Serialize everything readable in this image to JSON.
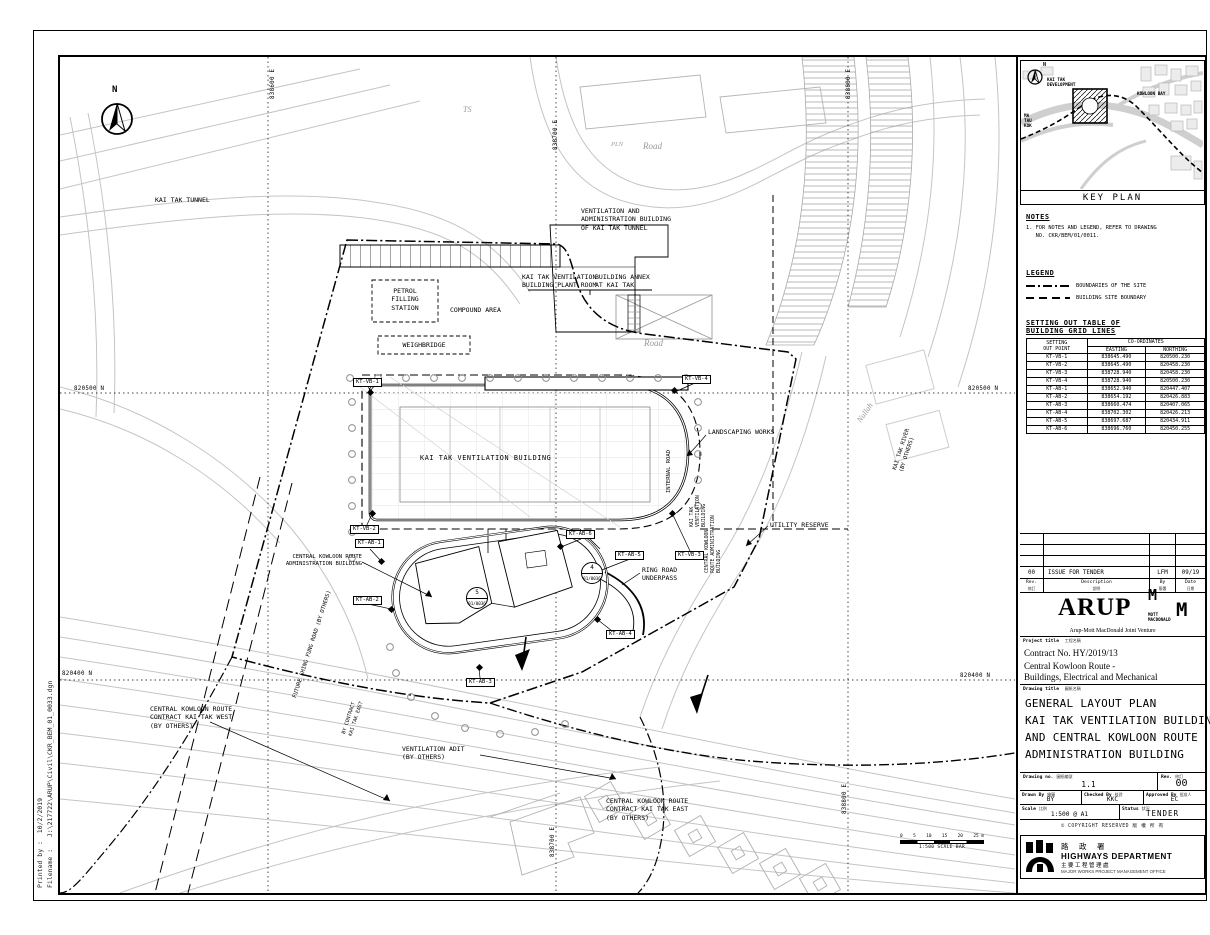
{
  "sheet": {
    "printed_by": "Printed by :  10/2/2019",
    "filename": "Filename :   J:\\217722\\ARUP\\Civil\\CKR_BEM_01_0033.dgn"
  },
  "plan": {
    "north": "N",
    "kai_tak_tunnel": "KAI TAK TUNNEL",
    "ts": "TS",
    "pln": "PLN",
    "road_top": "Road",
    "road_mid": "Road",
    "vent_admin_building": "VENTILATION AND\nADMINISTRATION BUILDING\nOF KAI TAK TUNNEL",
    "plant_room": "KAI TAK VENTILATION\nBUILDING PLANT ROOM",
    "building_annex": "BUILDING ANNEX\nAT KAI TAK",
    "petrol_station": "PETROL\nFILLING\nSTATION",
    "compound_area": "COMPOUND AREA",
    "weighbridge": "WEIGHBRIDGE",
    "main_building": "KAI TAK VENTILATION BUILDING",
    "internal_road": "INTERNAL ROAD",
    "landscaping": "LANDSCAPING WORKS",
    "utility_reserve": "UTILITY RESERVE",
    "kai_tak_river": "KAI TAK RIVER\n(BY OTHERS)",
    "nullah": "Nullah",
    "admin_building": "CENTRAL KOWLOON ROUTE\nADMINISTRATION BUILDING",
    "ring_road_underpass": "RING ROAD\nUNDERPASS",
    "vb_side": "KAI TAK\nVENTILATION\nBUILDING",
    "ab_side": "CENTRAL KOWLOON\nROUTE ADMINISTRATION\nBUILDING",
    "future_road": "FUTURE SHING FUNG ROAD (BY OTHERS)",
    "by_contract_east": "BY CONTRACT\nKAI TAK EAST",
    "ckr_west": "CENTRAL KOWLOON ROUTE\nCONTRACT KAI TAK WEST\n(BY OTHERS)",
    "vent_adit": "VENTILATION ADIT\n(BY OTHERS)",
    "ckr_east": "CENTRAL KOWLOON ROUTE\nCONTRACT KAI TAK EAST\n(BY OTHERS)",
    "grid_e1": "838600 E",
    "grid_e2": "838700 E",
    "grid_e3": "838800 E",
    "grid_n500": "820500 N",
    "grid_n400": "820400 N",
    "points": {
      "vb1": "KT-VB-1",
      "vb2": "KT-VB-2",
      "vb3": "KT-VB-3",
      "vb4": "KT-VB-4",
      "ab1": "KT-AB-1",
      "ab2": "KT-AB-2",
      "ab3": "KT-AB-3",
      "ab4": "KT-AB-4",
      "ab5": "KT-AB-5",
      "ab6": "KT-AB-6"
    },
    "section_4": {
      "num": "4",
      "ref": "01/0036"
    },
    "section_5": {
      "num": "5",
      "ref": "01/0036"
    },
    "scalebar": {
      "ticks": [
        "0",
        "5",
        "10",
        "15",
        "20",
        "25 m"
      ],
      "caption": "1:500 SCALE BAR"
    }
  },
  "keyplan": {
    "title": "KEY PLAN",
    "north": "N",
    "kai_tak_dev": "KAI TAK\nDEVELOPMENT",
    "kowloon_bay": "KOWLOON BAY",
    "ma_tau_kok": "MA\nTAU\nKOK"
  },
  "notes": {
    "heading": "NOTES",
    "item1": "1. FOR NOTES AND LEGEND, REFER TO DRAWING\n   NO. CKR/BEM/01/0011."
  },
  "legend": {
    "heading": "LEGEND",
    "site_boundary": "BOUNDARIES OF THE SITE",
    "building_boundary": "BUILDING SITE BOUNDARY"
  },
  "setting_out": {
    "heading": "SETTING OUT TABLE OF\nBUILDING GRID LINES",
    "col_point": "SETTING\nOUT POINT",
    "col_coords": "CO-ORDINATES",
    "col_easting": "EASTING",
    "col_northing": "NORTHING",
    "rows": [
      {
        "point": "KT-VB-1",
        "easting": "838645.490",
        "northing": "820500.230"
      },
      {
        "point": "KT-VB-2",
        "easting": "838645.490",
        "northing": "820458.230"
      },
      {
        "point": "KT-VB-3",
        "easting": "838728.940",
        "northing": "820458.230"
      },
      {
        "point": "KT-VB-4",
        "easting": "838728.940",
        "northing": "820500.230"
      },
      {
        "point": "KT-AB-1",
        "easting": "838652.940",
        "northing": "820447.407"
      },
      {
        "point": "KT-AB-2",
        "easting": "838654.192",
        "northing": "820426.883"
      },
      {
        "point": "KT-AB-3",
        "easting": "838660.474",
        "northing": "820407.065"
      },
      {
        "point": "KT-AB-4",
        "easting": "838702.302",
        "northing": "820426.213"
      },
      {
        "point": "KT-AB-5",
        "easting": "838697.687",
        "northing": "820434.911"
      },
      {
        "point": "KT-AB-6",
        "easting": "838696.760",
        "northing": "820450.255"
      }
    ]
  },
  "titleblock": {
    "revision": {
      "rev": "00",
      "description": "ISSUE FOR TENDER",
      "by": "LFM",
      "date": "09/19"
    },
    "rev_headers": {
      "rev": "Rev.",
      "rev_cn": "修訂",
      "description": "Description",
      "description_cn": "說明",
      "by": "By",
      "by_cn": "簽署",
      "date": "Date",
      "date_cn": "日期"
    },
    "firm": {
      "arup": "ARUP",
      "mott_m1": "M",
      "mott_m2": "M",
      "mott_name": "MOTT\nMACDONALD",
      "jv": "Arup-Mott MacDonald Joint Venture"
    },
    "project": {
      "label": "Project title",
      "label_cn": "工程名稱",
      "contract": "Contract No. HY/2019/13",
      "name": "Central Kowloon Route -\nBuildings, Electrical and Mechanical"
    },
    "drawing": {
      "label": "Drawing title",
      "label_cn": "圖紙名稱",
      "title": "GENERAL LAYOUT PLAN\nKAI TAK VENTILATION BUILDING\nAND CENTRAL KOWLOON ROUTE\nADMINISTRATION BUILDING"
    },
    "numbers": {
      "drawing_no_label": "Drawing no.",
      "drawing_no_cn": "圖紙編號",
      "drawing_no": "1.1",
      "rev_label": "Rev.",
      "rev_cn": "修訂",
      "rev": "00",
      "drawn_label": "Drawn By",
      "drawn_cn": "繪圖",
      "drawn": "BY",
      "checked_label": "Checked By",
      "checked_cn": "核對",
      "checked": "KKC",
      "approved_label": "Approved By",
      "approved_cn": "批准人",
      "approved": "EC",
      "scale_label": "Scale",
      "scale_cn": "比例",
      "scale": "1:500 @ A1",
      "status_label": "Status",
      "status_cn": "狀況",
      "status": "TENDER"
    },
    "copyright_en": "COPYRIGHT RESERVED",
    "copyright_cn": "版 權 所 有",
    "hyd": {
      "cn": "路 政 署",
      "en": "HIGHWAYS DEPARTMENT",
      "office_cn": "主要工程管理處",
      "office_en": "MAJOR WORKS PROJECT MANAGEMENT OFFICE"
    }
  }
}
